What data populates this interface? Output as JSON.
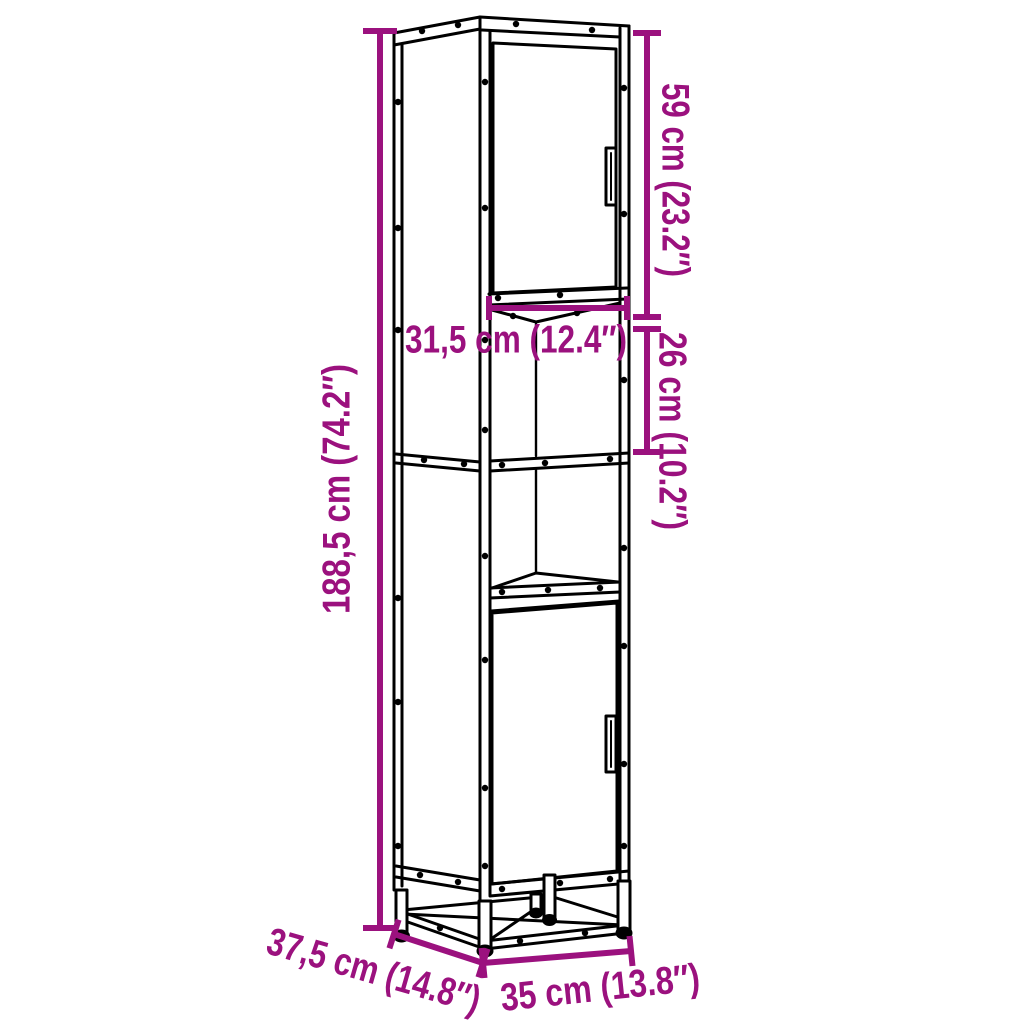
{
  "diagram": {
    "kind": "product-dimension-diagram",
    "subject": "tall-cabinet-line-drawing",
    "colors": {
      "dimension_accent": "#9B117E",
      "line": "#000000",
      "background": "#FFFFFF"
    },
    "dimensions": {
      "height": {
        "label": "188,5 cm (74.2″)",
        "cm": "188,5",
        "inches": "74.2"
      },
      "top_door_height": {
        "label": "59 cm (23.2″)",
        "cm": "59",
        "inches": "23.2"
      },
      "inner_width": {
        "label": "31,5 cm (12.4″)",
        "cm": "31,5",
        "inches": "12.4"
      },
      "open_section_height": {
        "label": "26 cm (10.2″)",
        "cm": "26",
        "inches": "10.2"
      },
      "depth": {
        "label": "37,5 cm (14.8″)",
        "cm": "37,5",
        "inches": "14.8"
      },
      "width": {
        "label": "35 cm (13.8″)",
        "cm": "35",
        "inches": "13.8"
      }
    }
  }
}
